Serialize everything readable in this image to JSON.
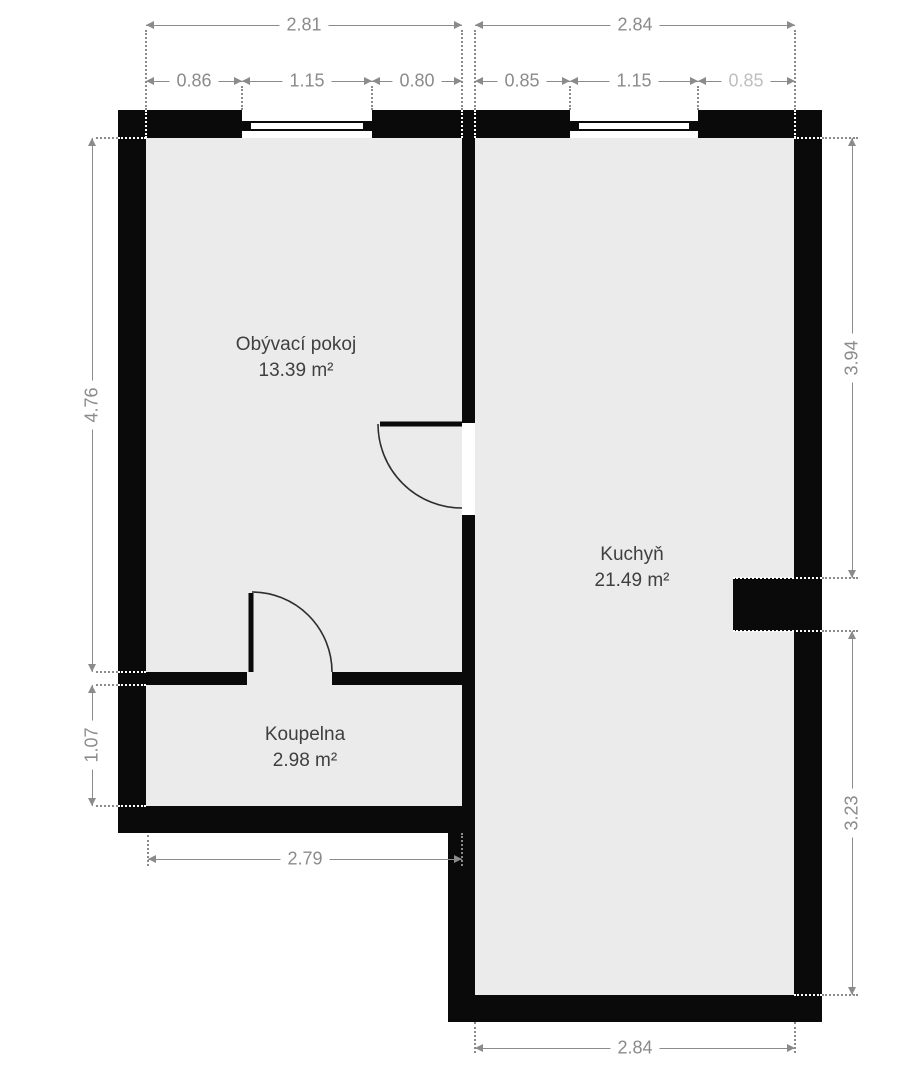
{
  "title": "Floor plan",
  "rooms": [
    {
      "name": "Obývací pokoj",
      "area": "13.39 m²"
    },
    {
      "name": "Kuchyň",
      "area": "21.49 m²"
    },
    {
      "name": "Koupelna",
      "area": "2.98 m²"
    }
  ],
  "dims": {
    "tl_total": "2.81",
    "tl_parts": [
      "0.86",
      "1.15",
      "0.80"
    ],
    "tr_total": "2.84",
    "tr_parts": [
      "0.85",
      "1.15",
      "0.85"
    ],
    "left_upper": "4.76",
    "left_lower": "1.07",
    "right_upper": "3.94",
    "right_lower": "3.23",
    "bottom_left": "2.79",
    "bottom_right": "2.84"
  },
  "colors": {
    "wall": "#0a0a0a",
    "floor": "#ebebeb",
    "dimension": "#8b8b8b",
    "dimension_faded": "#bfbfbf",
    "room_label": "#3f3f3f",
    "background": "#ffffff"
  }
}
